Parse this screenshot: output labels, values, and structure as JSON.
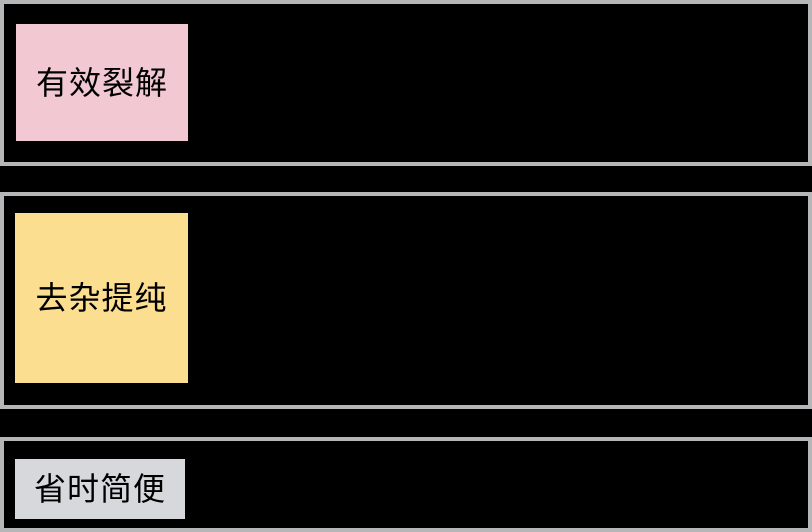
{
  "canvas": {
    "width": 812,
    "height": 532,
    "background_color": "#000000",
    "panel_border_color": "#b4b6b8",
    "panel_fill_color": "#000000",
    "text_color": "#000000"
  },
  "sections": [
    {
      "id": "lysis",
      "label": "有效裂解",
      "label_bg": "#f2c9d3"
    },
    {
      "id": "purification",
      "label": "去杂提纯",
      "label_bg": "#fbde8f"
    },
    {
      "id": "convenience",
      "label": "省时简便",
      "label_bg": "#d6d8db"
    }
  ]
}
